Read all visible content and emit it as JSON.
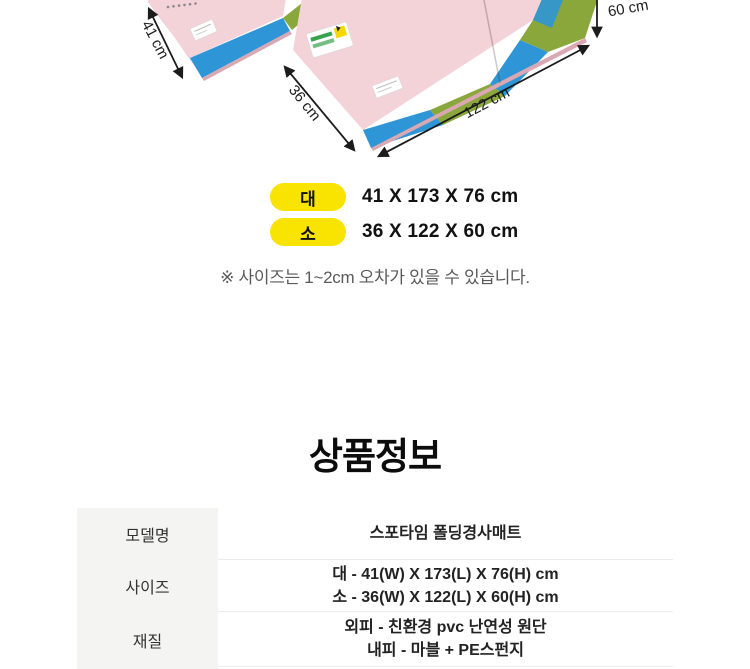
{
  "illustration": {
    "mats": "two pink folding wedge mats with blue and green side panels",
    "dimension_labels": {
      "large_width": "41 cm",
      "small_width": "36 cm",
      "small_length": "122 cm",
      "small_height": "60 cm"
    }
  },
  "size_summary": {
    "rows": [
      {
        "badge": "대",
        "dimensions": "41 X 173 X 76 cm"
      },
      {
        "badge": "소",
        "dimensions": "36 X 122 X 60 cm"
      }
    ],
    "note": "※ 사이즈는 1~2cm 오차가 있을 수 있습니다."
  },
  "product_info": {
    "title": "상품정보",
    "table": [
      {
        "label": "모델명",
        "values": [
          "스포타임 폴딩경사매트",
          ""
        ]
      },
      {
        "label": "사이즈",
        "values": [
          "대 - 41(W) X 173(L) X 76(H) cm",
          "소 - 36(W) X 122(L) X 60(H) cm"
        ]
      },
      {
        "label": "재질",
        "values": [
          "외피 - 친환경 pvc 난연성 원단",
          "내피 - 마블 + PE스펀지"
        ]
      }
    ]
  },
  "colors": {
    "mat_pink": "#f3d2d8",
    "mat_blue": "#2e96d6",
    "mat_green": "#8aa73c",
    "badge_yellow": "#f9e300",
    "table_label_bg": "#f4f4f2"
  }
}
